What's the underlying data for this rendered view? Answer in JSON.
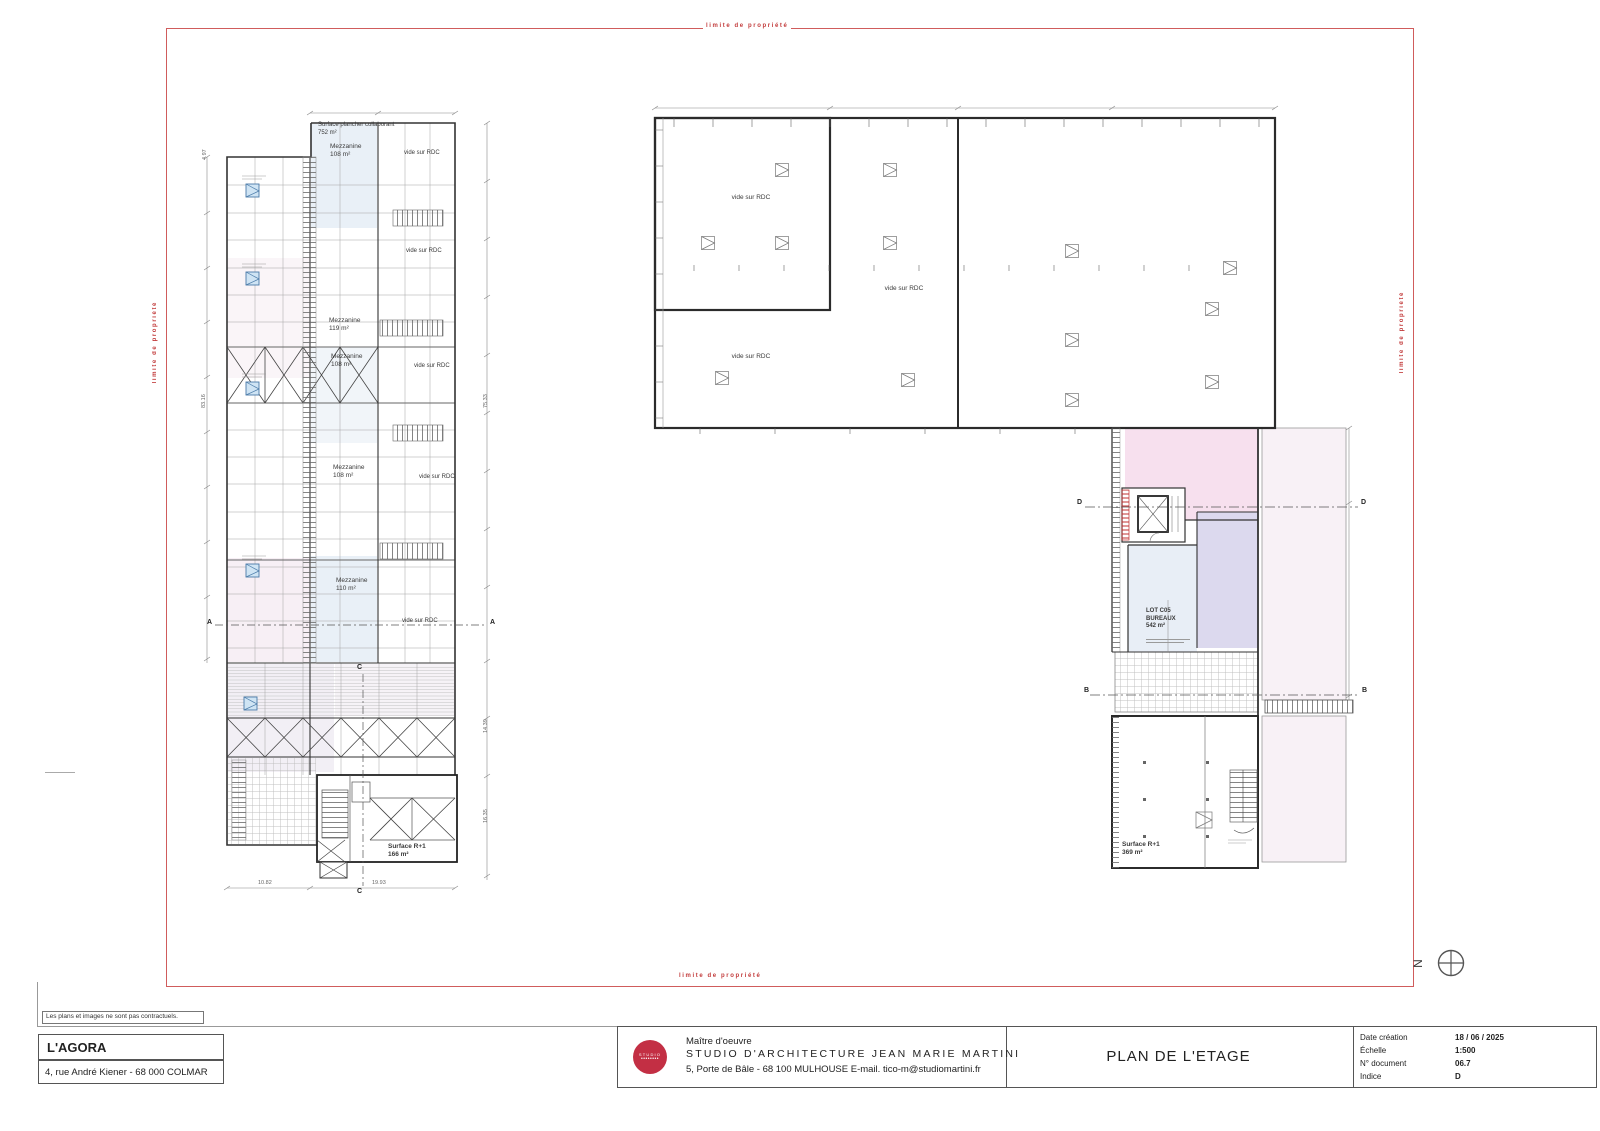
{
  "sheet": {
    "boundary_label": "limite de propriété",
    "disclaimer": "Les plans et images ne sont pas contractuels.",
    "north": "N"
  },
  "project": {
    "name": "L'AGORA",
    "address": "4, rue André Kiener - 68 000 COLMAR"
  },
  "titleblock": {
    "logo_line1": "STUDIO",
    "logo_line2": "••••••••",
    "role": "Maître d'oeuvre",
    "firm": "STUDIO D'ARCHITECTURE JEAN MARIE MARTINI",
    "contact": "5, Porte de Bâle - 68 100 MULHOUSE  E-mail. tico-m@studiomartini.fr",
    "drawing_title": "PLAN DE L'ETAGE",
    "meta": [
      {
        "label": "Date création",
        "value": "18 / 06 / 2025"
      },
      {
        "label": "Échelle",
        "value": "1:500"
      },
      {
        "label": "N° document",
        "value": "06.7"
      },
      {
        "label": "Indice",
        "value": "D"
      }
    ]
  },
  "left_plan": {
    "surface_note_1": "Surface plancher collaborant",
    "surface_note_2": "752 m²",
    "vide": "vide sur RDC",
    "mezzanines": [
      {
        "name": "Mezzanine",
        "area": "108 m²"
      },
      {
        "name": "Mezzanine",
        "area": "119 m²"
      },
      {
        "name": "Mezzanine",
        "area": "108 m²"
      },
      {
        "name": "Mezzanine",
        "area": "108 m²"
      },
      {
        "name": "Mezzanine",
        "area": "110 m²"
      }
    ],
    "surface_r1_1": "Surface R+1",
    "surface_r1_2": "166 m²",
    "dims": {
      "d1": "4.97",
      "d2": "83.16",
      "d3": "75.33",
      "d4": "14.39",
      "d5": "16.35",
      "d6": "10.82",
      "d7": "19.93"
    },
    "section_a": "A",
    "section_c": "C"
  },
  "right_plan": {
    "vide": "vide sur RDC",
    "lot_line1": "LOT C05",
    "lot_line2": "BUREAUX",
    "lot_area": "542 m²",
    "surface_r1_1": "Surface R+1",
    "surface_r1_2": "369 m²",
    "section_b": "B",
    "section_d": "D"
  }
}
